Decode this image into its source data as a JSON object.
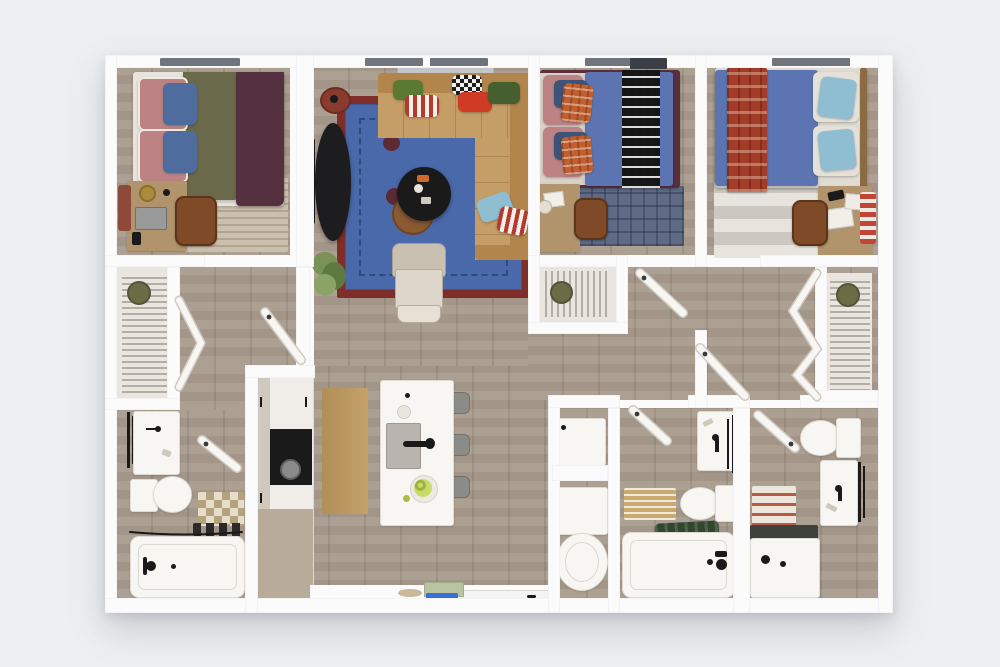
{
  "title": "3D top-down floor plan — 3 bedroom / 3 bathroom apartment",
  "palette": {
    "bg": "#edeff1",
    "wall": "#fbfbfc",
    "floor": "#a89b8c",
    "floor-line": "#998d7f",
    "closet-floor": "#e9e6e0",
    "window": "#70757b",
    "fixture": "#f7f6f3",
    "rug-blue": "#4a69ab",
    "rug-blue-border": "#2b4a7d",
    "rug-red": "#7e2d28",
    "sofa": "#c59d66",
    "sofa-dark": "#b2854d",
    "bed-blue": "#5c75b2",
    "duvet-olive": "#6a694a",
    "duvet-maroon": "#55303f",
    "pillow-pink": "#bd8384",
    "pillow-blue": "#4f6c9e",
    "pillow-lightblue": "#8fbdd2",
    "plaid-orange": "#c06030",
    "plaid-red": "#a23c28",
    "wood-desk": "#b1946b",
    "chair-brown": "#7e4a28",
    "rug-beige": "#cbbfae",
    "rug-bluegray": "#5f6b85",
    "checker": "#b3a27c",
    "runner-tan": "#bf9a5d",
    "cab-tan": "#b9ab99",
    "black": "#1a1a1a",
    "stool": "#8b8b88",
    "plant": "#7a9258",
    "plant-dark": "#5e7a42",
    "towel-green": "#31462f",
    "mat-green": "#b9c4a2",
    "mat-blue": "#3a6fd8",
    "mat-tan": "#c8a96e",
    "hat": "#6b6b45",
    "door-leaf": "#f8f6f3",
    "door-edge": "#cfcac2"
  },
  "rooms": {
    "bedroom_1": {
      "position": "top-left",
      "furniture": [
        "double bed with olive and maroon duvets",
        "pink and blue pillows",
        "desk with lamp and laptop",
        "brown office chair",
        "striped beige rug",
        "window"
      ]
    },
    "living_room": {
      "position": "top-center",
      "furniture": [
        "L-shaped tan sectional sofa",
        "throw pillows green red striped checkered",
        "blue shag rug with red border",
        "round black coffee table",
        "round wood side table",
        "black oval TV console",
        "wall TV",
        "red round stool",
        "beige accent chair",
        "potted plant",
        "window"
      ]
    },
    "bedroom_2": {
      "position": "top-middle-right",
      "furniture": [
        "double bed blue duvet with black-white runner",
        "rose and orange plaid pillows",
        "desk",
        "brown chair",
        "blue-gray plaid rug",
        "window",
        "wire-shelf closet"
      ]
    },
    "bedroom_3": {
      "position": "top-right",
      "furniture": [
        "double bed blue duvet with red plaid runner",
        "white and light-blue pillows",
        "desk with papers",
        "brown chair",
        "gray striped rug",
        "striped board",
        "window",
        "walk-in wire-shelf closet with bifold doors"
      ]
    },
    "closet_1": {
      "position": "mid-left",
      "furniture": [
        "wire shelving with hanging clothes",
        "hat",
        "bifold doors"
      ]
    },
    "bathroom_1": {
      "position": "bottom-left",
      "furniture": [
        "vanity sink",
        "toilet",
        "checkered rug",
        "bathtub with curtain rod",
        "towel rack"
      ]
    },
    "kitchen": {
      "position": "bottom-center-left",
      "furniture": [
        "cabinet run with black cooktop",
        "tan lower cabinets",
        "white island with sink and faucet",
        "fruit bowl",
        "three gray stools",
        "tan runner rug"
      ]
    },
    "entry": {
      "position": "bottom-center",
      "furniture": [
        "entry door",
        "green doormat",
        "blue mat",
        "tan mat"
      ]
    },
    "laundry": {
      "position": "bottom-middle",
      "furniture": [
        "dryer",
        "washer",
        "round top-load machine"
      ]
    },
    "bathroom_2": {
      "position": "bottom-middle-right",
      "furniture": [
        "vanity sink",
        "toilet",
        "striped tan bath mat",
        "bathtub",
        "green towel",
        "towel rack"
      ]
    },
    "bathroom_3": {
      "position": "bottom-right",
      "furniture": [
        "toilet",
        "vanity sink",
        "red striped bath mat",
        "walk-in shower",
        "towel rack"
      ]
    }
  },
  "counts": {
    "bedrooms": 3,
    "bathrooms": 3,
    "windows": 4,
    "closets": 3
  }
}
